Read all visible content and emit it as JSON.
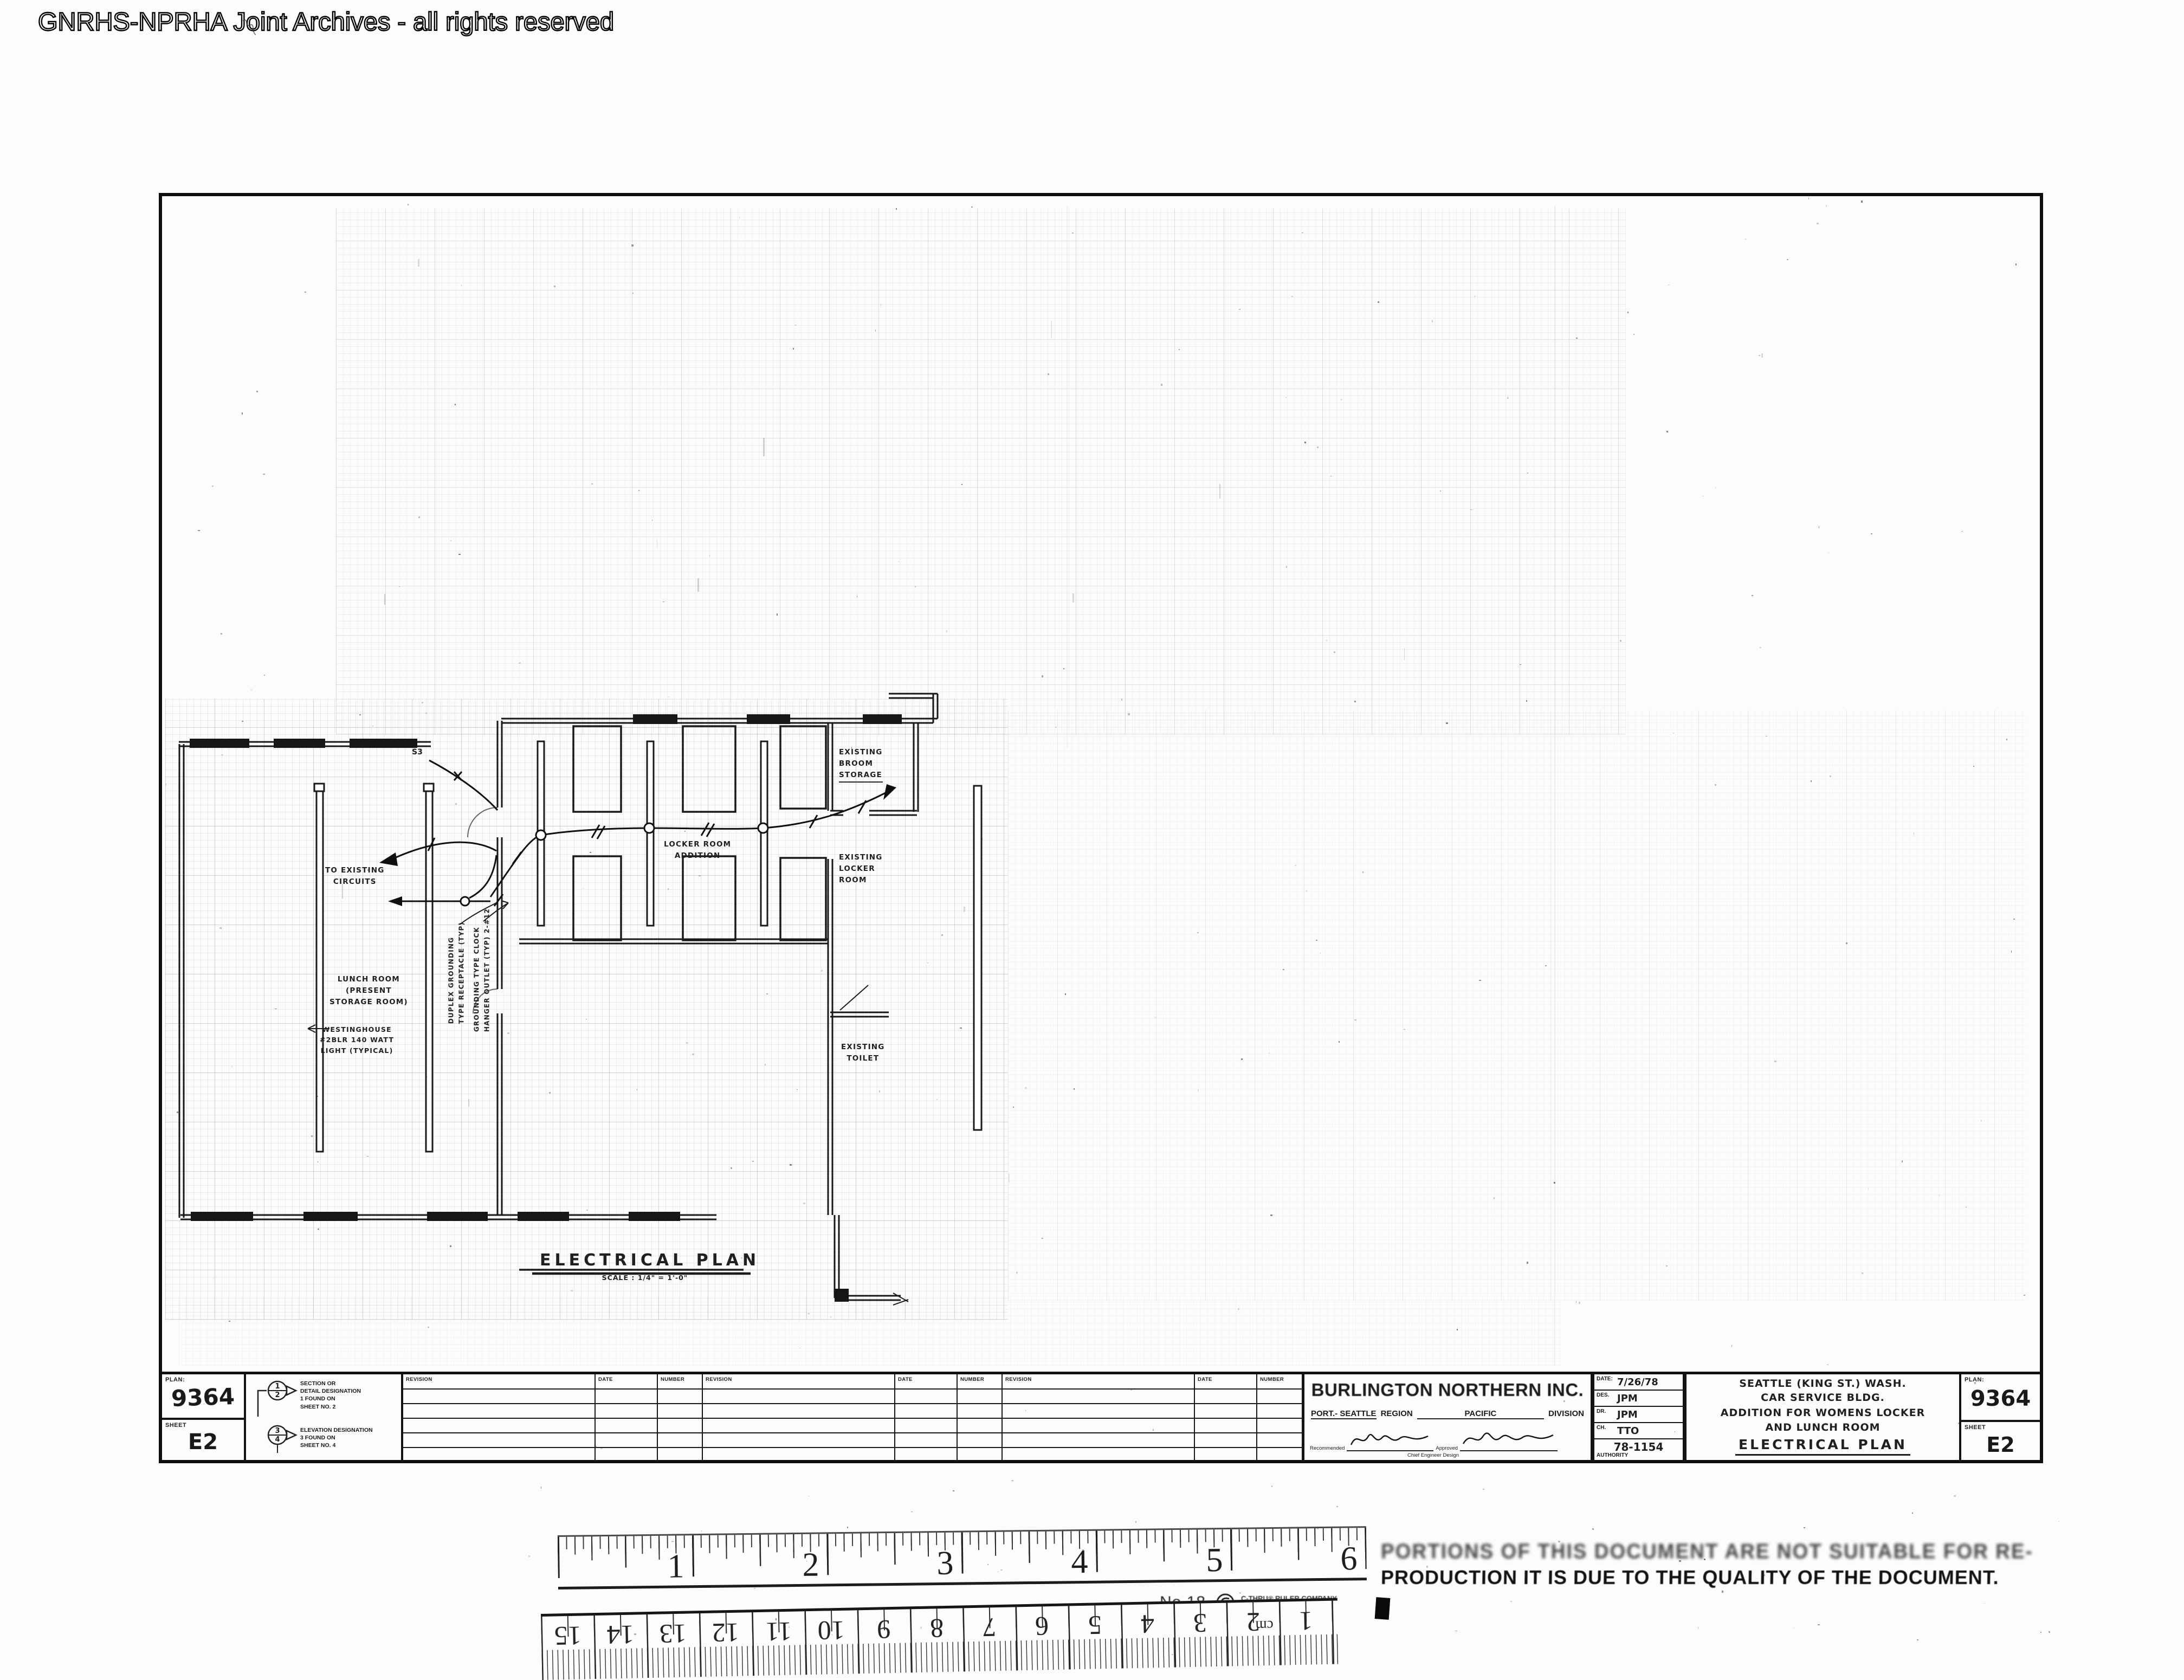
{
  "watermark": "GNRHS-NPRHA Joint Archives - all rights reserved",
  "drawing": {
    "title": "ELECTRICAL PLAN",
    "scale_note": "SCALE : 1/4\" = 1'-0\"",
    "switch_label": "S3",
    "labels": {
      "to_existing_circuits": [
        "TO EXISTING",
        "CIRCUITS"
      ],
      "lunch_room": [
        "LUNCH ROOM",
        "(PRESENT",
        "STORAGE ROOM)"
      ],
      "light_note": [
        "WESTINGHOUSE",
        "#2BLR 140 WATT",
        "LIGHT (TYPICAL)"
      ],
      "receptacle_note": [
        "DUPLEX GROUNDING",
        "TYPE RECEPTACLE (TYP)"
      ],
      "clock_note": [
        "GROUNDING TYPE CLOCK",
        "HANGER OUTLET (TYP) 2-#12"
      ],
      "locker_room_addition": [
        "LOCKER ROOM",
        "ADDITION"
      ],
      "existing_locker_room": [
        "EXISTING",
        "LOCKER",
        "ROOM"
      ],
      "existing_broom_storage": [
        "EXISTING",
        "BROOM",
        "STORAGE"
      ],
      "existing_toilet": [
        "EXISTING",
        "TOILET"
      ]
    }
  },
  "title_block": {
    "left_box": {
      "plan_label": "PLAN:",
      "plan_value": "9364",
      "sheet_label": "SHEET",
      "sheet_value": "E2"
    },
    "legend": {
      "section_top": "1",
      "section_bottom": "2",
      "section_lines": [
        "SECTION OR",
        "DETAIL DESIGNATION",
        "1 FOUND ON",
        "SHEET NO. 2"
      ],
      "elevation_top": "3",
      "elevation_bottom": "4",
      "elevation_lines": [
        "ELEVATION DESIGNATION",
        "3 FOUND ON",
        "SHEET NO. 4"
      ]
    },
    "revisions": {
      "headers": [
        "REVISION",
        "DATE",
        "NUMBER"
      ]
    },
    "company": {
      "name": "BURLINGTON NORTHERN INC.",
      "port": "PORT.- SEATTLE",
      "region_label": "REGION",
      "division_value": "PACIFIC",
      "division_label": "DIVISION",
      "recommended": "Recommended",
      "approved": "Approved",
      "chief": "Chief Engineer Design"
    },
    "approvals": {
      "date_label": "DATE:",
      "date_value": "7/26/78",
      "des_label": "DES.",
      "des_value": "JPM",
      "dr_label": "DR.",
      "dr_value": "JPM",
      "ch_label": "CH.",
      "ch_value": "TTO",
      "authority_value": "78-1154",
      "authority_label": "AUTHORITY"
    },
    "project": {
      "line1": "SEATTLE (KING ST.) WASH.",
      "line2": "CAR SERVICE BLDG.",
      "line3": "ADDITION FOR WOMENS LOCKER",
      "line4": "AND LUNCH ROOM",
      "title": "ELECTRICAL PLAN"
    },
    "right_box": {
      "plan_label": "PLAN:",
      "plan_value": "9364",
      "sheet_label": "SHEET",
      "sheet_value": "E2"
    }
  },
  "rulers": {
    "inch": {
      "numbers": [
        "1",
        "2",
        "3",
        "4",
        "5",
        "6"
      ],
      "no_label": "No.18",
      "brand": "C-THRU® RULER COMPANY",
      "brand_location": "BLOOMFIELD CONN. U.S.A."
    },
    "metric": {
      "numbers": [
        "15",
        "14",
        "13",
        "12",
        "11",
        "10",
        "9",
        "8",
        "7",
        "6",
        "5",
        "4",
        "3",
        "2",
        "1"
      ],
      "unit": "cm"
    }
  },
  "stamp": {
    "line1": "PORTIONS OF THIS DOCUMENT ARE NOT SUITABLE FOR RE-",
    "line2": "PRODUCTION IT IS DUE TO THE QUALITY OF THE DOCUMENT."
  }
}
